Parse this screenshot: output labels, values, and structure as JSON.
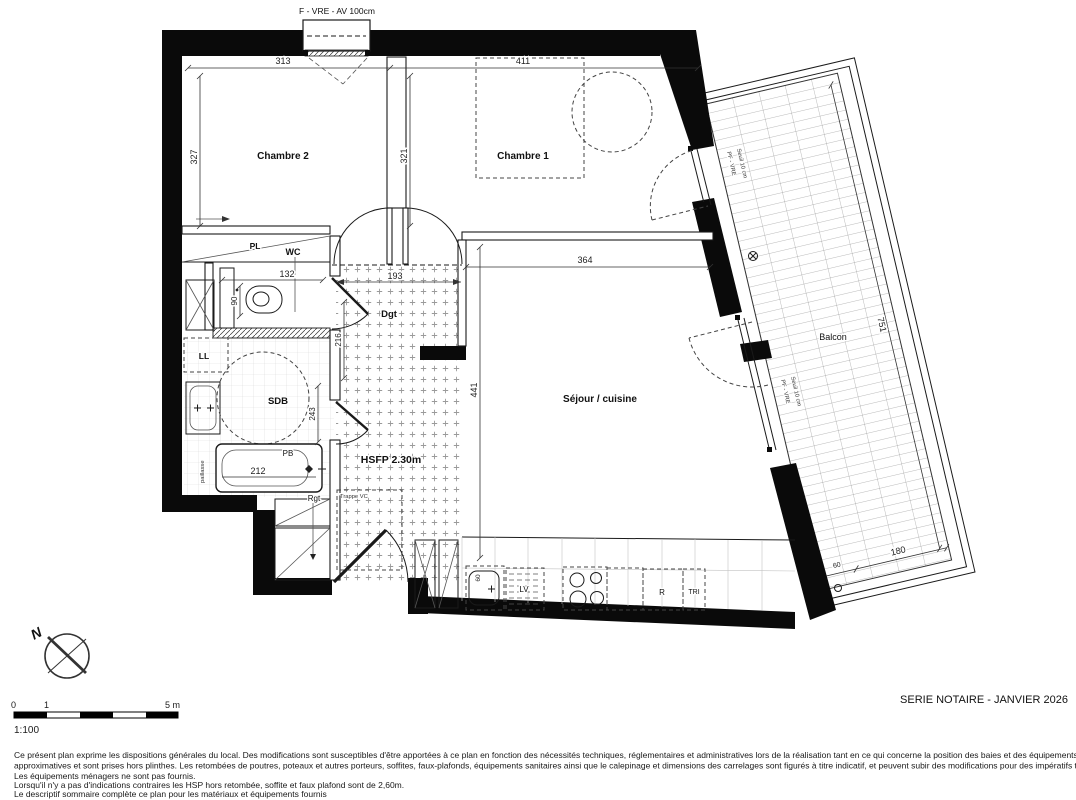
{
  "plan": {
    "rooms": {
      "chambre2": "Chambre 2",
      "chambre1": "Chambre 1",
      "wc": "WC",
      "sdb": "SDB",
      "dgt": "Dgt",
      "sejour": "Séjour / cuisine",
      "balcon": "Balcon"
    },
    "annotations": {
      "window_top": "F - VRE - AV 100cm",
      "pl": "PL",
      "ll": "LL",
      "pb": "PB",
      "rgt": "Rgt",
      "paillasse": "paillasse",
      "hsfp": "HSFP 2.30m",
      "trappe": "Trappe VC",
      "lv": "LV",
      "r": "R",
      "tri": "TRI",
      "pf_vre": "PF - VRE",
      "seuil": "Seuil 10 cm",
      "north": "N"
    },
    "dims": {
      "chambre2_w": "313",
      "chambre1_w": "411",
      "chambre2_h": "327",
      "chambre1_h": "321",
      "wc_w": "132",
      "wc_h": "90",
      "dgt_w": "193",
      "dgt_h": "216",
      "sdb_h": "243",
      "bath_w": "212",
      "sejour_w": "364",
      "sejour_h": "441",
      "balcon_l": "751",
      "balcon_w": "180",
      "balcon_x": "60",
      "kitchen_d": "60"
    }
  },
  "footer": {
    "scale": {
      "t0": "0",
      "t1": "1",
      "t5": "5 m",
      "ratio": "1:100"
    },
    "title": "SERIE NOTAIRE - JANVIER 2026",
    "disclaimer": [
      "Ce présent plan exprime les dispositions générales du local. Des modifications sont susceptibles d'être apportées à ce plan en fonction des nécessités techniques, réglementaires et administratives lors de la réalisation tant en ce qui concerne la position des baies et des équipements. Les surfaces sont",
      "approximatives et sont prises hors plinthes. Les retombées de poutres, poteaux et autres porteurs, soffites, faux-plafonds, équipements sanitaires ainsi que le calepinage et dimensions des carrelages sont figurés à titre indicatif, et peuvent subir des modifications pour des impératifs techniques.",
      "Les équipements ménagers ne sont pas fournis.",
      "Lorsqu'il n'y a pas d'indications contraires les HSP hors retombée, soffite et faux plafond sont de 2,60m.",
      "Le descriptif sommaire complète ce plan pour les matériaux et équipements fournis"
    ]
  }
}
